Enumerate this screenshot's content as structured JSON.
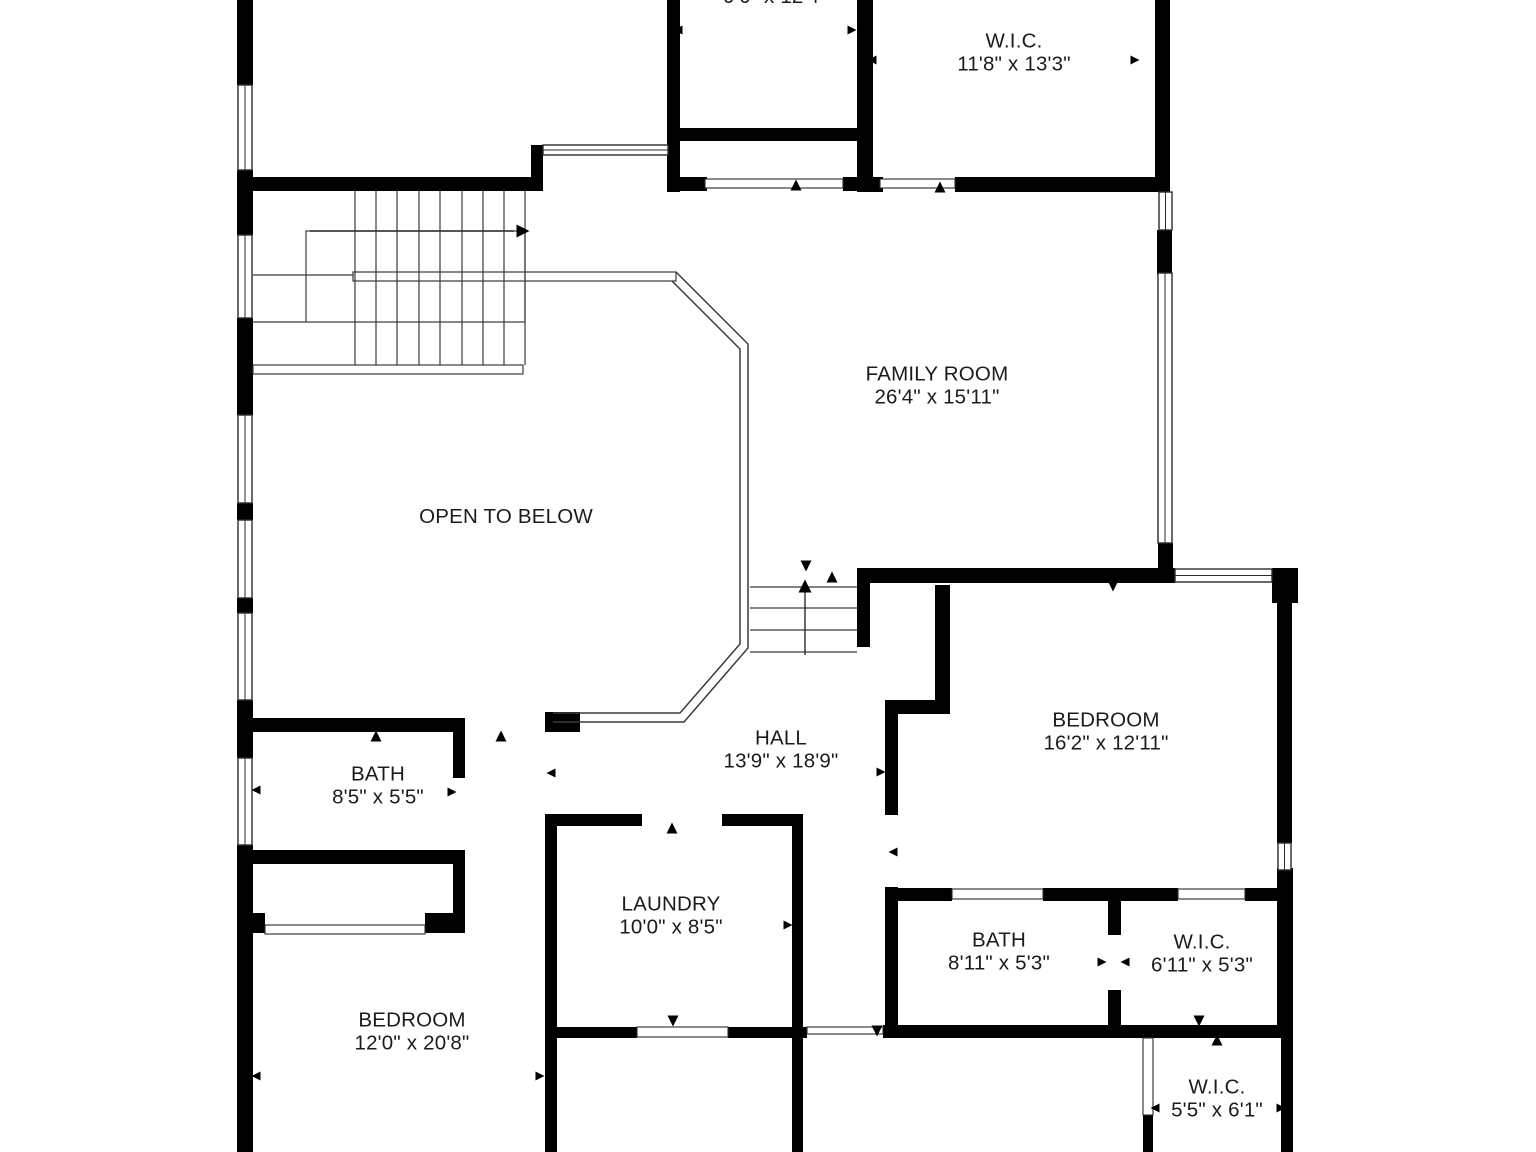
{
  "colors": {
    "wall": "#000000",
    "line": "#2b2b2b",
    "thin": "#3a3a3a",
    "bg": "#ffffff",
    "text": "#1b1b1b"
  },
  "rooms": [
    {
      "id": "upper-room",
      "name": "",
      "dims": "9'6\" x 12'4\"",
      "cx": 775,
      "cy": -3
    },
    {
      "id": "wic-top",
      "name": "W.I.C.",
      "dims": "11'8\" x 13'3\"",
      "cx": 1014,
      "cy": 53
    },
    {
      "id": "family-room",
      "name": "FAMILY ROOM",
      "dims": "26'4\" x 15'11\"",
      "cx": 937,
      "cy": 386
    },
    {
      "id": "open-to-below",
      "name": "OPEN TO BELOW",
      "dims": "",
      "cx": 506,
      "cy": 517
    },
    {
      "id": "bath-left",
      "name": "BATH",
      "dims": "8'5\" x 5'5\"",
      "cx": 378,
      "cy": 786
    },
    {
      "id": "hall",
      "name": "HALL",
      "dims": "13'9\" x 18'9\"",
      "cx": 781,
      "cy": 750
    },
    {
      "id": "bedroom-right",
      "name": "BEDROOM",
      "dims": "16'2\" x 12'11\"",
      "cx": 1106,
      "cy": 732
    },
    {
      "id": "laundry",
      "name": "LAUNDRY",
      "dims": "10'0\" x 8'5\"",
      "cx": 671,
      "cy": 916
    },
    {
      "id": "bath-right",
      "name": "BATH",
      "dims": "8'11\" x 5'3\"",
      "cx": 999,
      "cy": 952
    },
    {
      "id": "wic-mid",
      "name": "W.I.C.",
      "dims": "6'11\" x 5'3\"",
      "cx": 1202,
      "cy": 954
    },
    {
      "id": "bedroom-left",
      "name": "BEDROOM",
      "dims": "12'0\" x 20'8\"",
      "cx": 412,
      "cy": 1032
    },
    {
      "id": "wic-bottom",
      "name": "W.I.C.",
      "dims": "5'5\" x 6'1\"",
      "cx": 1217,
      "cy": 1099
    }
  ],
  "floorplan": {
    "walls": [
      [
        237,
        0,
        16,
        85
      ],
      [
        237,
        170,
        16,
        65
      ],
      [
        237,
        318,
        16,
        97
      ],
      [
        237,
        503,
        16,
        17
      ],
      [
        237,
        598,
        16,
        15
      ],
      [
        237,
        700,
        16,
        58
      ],
      [
        237,
        845,
        16,
        307
      ],
      [
        667,
        0,
        13,
        192
      ],
      [
        857,
        0,
        16,
        192
      ],
      [
        667,
        128,
        203,
        13
      ],
      [
        237,
        177,
        296,
        14
      ],
      [
        531,
        145,
        12,
        46
      ],
      [
        667,
        177,
        40,
        14
      ],
      [
        843,
        177,
        30,
        14
      ],
      [
        873,
        177,
        10,
        15
      ],
      [
        955,
        177,
        202,
        15
      ],
      [
        1155,
        0,
        15,
        192
      ],
      [
        1157,
        230,
        15,
        45
      ],
      [
        1158,
        543,
        15,
        40
      ],
      [
        857,
        568,
        318,
        15
      ],
      [
        1272,
        568,
        26,
        35
      ],
      [
        1277,
        603,
        15,
        240
      ],
      [
        1277,
        868,
        16,
        160
      ],
      [
        1281,
        1028,
        12,
        124
      ],
      [
        857,
        575,
        13,
        72
      ],
      [
        935,
        585,
        15,
        127
      ],
      [
        885,
        700,
        65,
        14
      ],
      [
        885,
        714,
        13,
        101
      ],
      [
        885,
        887,
        13,
        151
      ],
      [
        898,
        888,
        54,
        13
      ],
      [
        1043,
        888,
        135,
        13
      ],
      [
        1245,
        888,
        48,
        13
      ],
      [
        1108,
        901,
        13,
        34
      ],
      [
        1108,
        990,
        13,
        36
      ],
      [
        883,
        1025,
        400,
        13
      ],
      [
        1143,
        1115,
        10,
        37
      ],
      [
        545,
        814,
        97,
        12
      ],
      [
        722,
        814,
        81,
        12
      ],
      [
        545,
        814,
        12,
        216
      ],
      [
        792,
        814,
        11,
        338
      ],
      [
        545,
        1027,
        92,
        11
      ],
      [
        728,
        1027,
        79,
        11
      ],
      [
        545,
        1038,
        12,
        114
      ],
      [
        253,
        718,
        212,
        14
      ],
      [
        545,
        712,
        35,
        20
      ],
      [
        453,
        718,
        12,
        60
      ],
      [
        453,
        852,
        12,
        13
      ],
      [
        253,
        850,
        212,
        14
      ],
      [
        453,
        864,
        12,
        69
      ],
      [
        237,
        913,
        28,
        20
      ],
      [
        425,
        913,
        40,
        20
      ]
    ],
    "windows": [
      [
        238,
        85,
        14,
        85
      ],
      [
        238,
        235,
        14,
        83
      ],
      [
        238,
        415,
        14,
        88
      ],
      [
        238,
        520,
        14,
        78
      ],
      [
        238,
        613,
        14,
        87
      ],
      [
        238,
        758,
        14,
        87
      ],
      [
        1159,
        192,
        13,
        38
      ],
      [
        1158,
        273,
        14,
        270
      ],
      [
        1175,
        569,
        97,
        13
      ],
      [
        1278,
        843,
        13,
        27
      ],
      [
        543,
        145,
        125,
        10
      ]
    ],
    "thresholds": [
      [
        705,
        179,
        138,
        9
      ],
      [
        880,
        179,
        75,
        9
      ],
      [
        253,
        365,
        270,
        9
      ],
      [
        265,
        925,
        160,
        9
      ],
      [
        952,
        889,
        91,
        10
      ],
      [
        1178,
        889,
        67,
        10
      ],
      [
        637,
        1027,
        91,
        10
      ],
      [
        807,
        1027,
        76,
        7
      ],
      [
        1143,
        1038,
        10,
        77
      ]
    ],
    "boxes": [
      [
        306,
        231,
        219,
        91
      ],
      [
        353,
        272,
        323,
        9
      ]
    ],
    "stair_lines": [
      [
        355,
        191,
        355,
        365
      ],
      [
        376,
        191,
        376,
        365
      ],
      [
        397,
        191,
        397,
        365
      ],
      [
        419,
        191,
        419,
        365
      ],
      [
        440,
        191,
        440,
        365
      ],
      [
        462,
        191,
        462,
        365
      ],
      [
        483,
        191,
        483,
        365
      ],
      [
        504,
        191,
        504,
        365
      ],
      [
        525,
        191,
        525,
        365
      ],
      [
        253,
        275,
        353,
        275
      ],
      [
        253,
        322,
        306,
        322
      ],
      [
        750,
        587,
        857,
        587
      ],
      [
        750,
        608,
        857,
        608
      ],
      [
        750,
        630,
        857,
        630
      ],
      [
        750,
        652,
        857,
        652
      ]
    ],
    "railings": [
      "M676,272 L748,344 L748,648 L684,722 L553,722",
      "M672,281 L740,349 L740,644 L680,713 L553,713"
    ],
    "arrows": [
      {
        "stem": [
          310,
          231,
          514,
          231
        ],
        "head": [
          523,
          231
        ],
        "dir": "right"
      },
      {
        "stem": [
          805,
          655,
          805,
          592
        ],
        "head": [
          805,
          586
        ],
        "dir": "up"
      }
    ],
    "door_markers": [
      [
        796,
        185,
        "up"
      ],
      [
        940,
        187,
        "up"
      ],
      [
        376,
        736,
        "up"
      ],
      [
        501,
        736,
        "up"
      ],
      [
        672,
        828,
        "up"
      ],
      [
        673,
        1021,
        "down"
      ],
      [
        877,
        1031,
        "down"
      ],
      [
        1113,
        586,
        "down"
      ],
      [
        1199,
        1021,
        "down"
      ],
      [
        1217,
        1040,
        "up"
      ],
      [
        806,
        566,
        "down"
      ],
      [
        832,
        577,
        "up"
      ]
    ],
    "dim_markers": [
      [
        678,
        30,
        "left"
      ],
      [
        852,
        30,
        "right"
      ],
      [
        872,
        60,
        "left"
      ],
      [
        1135,
        60,
        "right"
      ],
      [
        256,
        790,
        "left"
      ],
      [
        452,
        792,
        "right"
      ],
      [
        256,
        1076,
        "left"
      ],
      [
        540,
        1076,
        "right"
      ],
      [
        550,
        924,
        "left"
      ],
      [
        788,
        925,
        "right"
      ],
      [
        1102,
        962,
        "right"
      ],
      [
        1125,
        962,
        "left"
      ],
      [
        1155,
        1108,
        "left"
      ],
      [
        1281,
        1108,
        "right"
      ],
      [
        881,
        772,
        "right"
      ],
      [
        893,
        852,
        "left"
      ],
      [
        551,
        773,
        "left"
      ]
    ]
  }
}
